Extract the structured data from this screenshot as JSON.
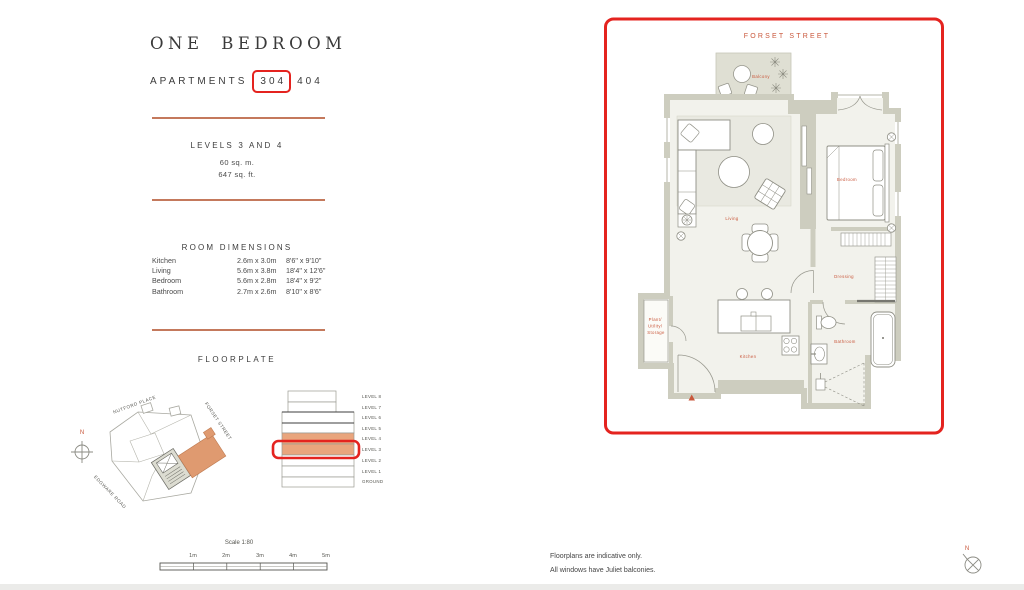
{
  "title": {
    "main": "ONE BEDROOM",
    "sub_prefix": "APARTMENTS",
    "unit_boxed": "304",
    "unit_other": "404"
  },
  "levels": {
    "heading": "LEVELS 3 AND 4",
    "area_metric": "60 sq. m.",
    "area_imperial": "647 sq. ft."
  },
  "room_dimensions": {
    "heading": "ROOM DIMENSIONS",
    "rows": [
      {
        "room": "Kitchen",
        "metric": "2.6m x 3.0m",
        "imperial": "8'6\" x 9'10\""
      },
      {
        "room": "Living",
        "metric": "5.6m x 3.8m",
        "imperial": "18'4\" x 12'6\""
      },
      {
        "room": "Bedroom",
        "metric": "5.6m x 2.8m",
        "imperial": "18'4\" x 9'2\""
      },
      {
        "room": "Bathroom",
        "metric": "2.7m x 2.6m",
        "imperial": "8'10\" x 8'6\""
      }
    ]
  },
  "floorplate": {
    "heading": "FLOORPLATE",
    "north_label": "N",
    "streets": {
      "top": "NUTFORD PLACE",
      "right": "FORSET STREET",
      "left": "EDGWARE ROAD"
    },
    "levels": [
      "LEVEL 8",
      "LEVEL 7",
      "LEVEL 6",
      "LEVEL 5",
      "LEVEL 4",
      "LEVEL 3",
      "LEVEL 2",
      "LEVEL 1",
      "GROUND"
    ],
    "highlighted_levels": [
      "LEVEL 4",
      "LEVEL 3"
    ],
    "boxed_level": "LEVEL 3"
  },
  "scale_bar": {
    "label": "Scale 1:80",
    "ticks": [
      "1m",
      "2m",
      "3m",
      "4m",
      "5m"
    ]
  },
  "plan": {
    "street": "FORSET STREET",
    "labels": {
      "balcony": "Balcony",
      "living": "Living",
      "bedroom": "Bedroom",
      "dressing": "Dressing",
      "bathroom": "Bathroom",
      "kitchen": "Kitchen",
      "storage": [
        "Plant/",
        "Utility/",
        "Storage"
      ]
    }
  },
  "footer": {
    "line1": "Floorplans are indicative only.",
    "line2": "All windows have Juliet balconies.",
    "north_label": "N"
  },
  "colors": {
    "highlight_red": "#e4231f",
    "label_orange": "#c9573b",
    "rule_orange": "#c4795c",
    "stack_orange": "#e9a57d",
    "wall_beige": "#cdcdbf",
    "floor": "#f2f2ec",
    "balcony_floor": "#dfdfd3",
    "text": "#3c3c3c"
  }
}
